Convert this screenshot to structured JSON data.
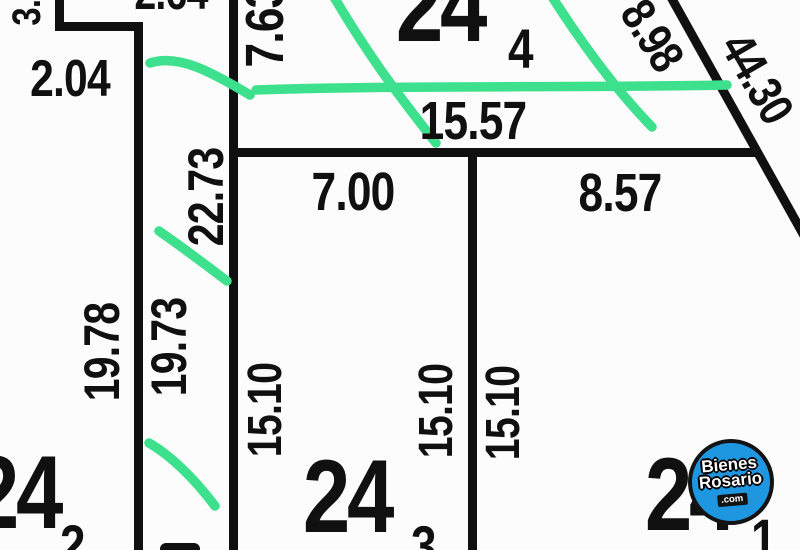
{
  "plan": {
    "measurements": {
      "m_3_0": "3.0",
      "m_2_04": "2.04",
      "m_2_64": "2.64",
      "m_7_63": "7.63",
      "m_15_57": "15.57",
      "m_7_00": "7.00",
      "m_8_57": "8.57",
      "m_22_73": "22.73",
      "m_19_78": "19.78",
      "m_19_73": "19.73",
      "m_15_10_a": "15.10",
      "m_15_10_b": "15.10",
      "m_15_10_c": "15.10",
      "m_8_98": "8.98",
      "m_44_30": "44.30"
    },
    "parcels": {
      "p4": {
        "number": "24",
        "subscript": "4"
      },
      "p3": {
        "number": "24",
        "subscript": "3"
      },
      "p2": {
        "number": "24",
        "subscript": "2"
      },
      "p1": {
        "number": "24",
        "subscript": "1"
      }
    }
  },
  "watermark": {
    "brand_top": "Bienes",
    "brand_bottom": "Rosario",
    "domain": ".com"
  },
  "colors": {
    "boundary_line": "#101010",
    "highlight_green": "#3de08c",
    "logo_blue": "#1f97e0"
  }
}
